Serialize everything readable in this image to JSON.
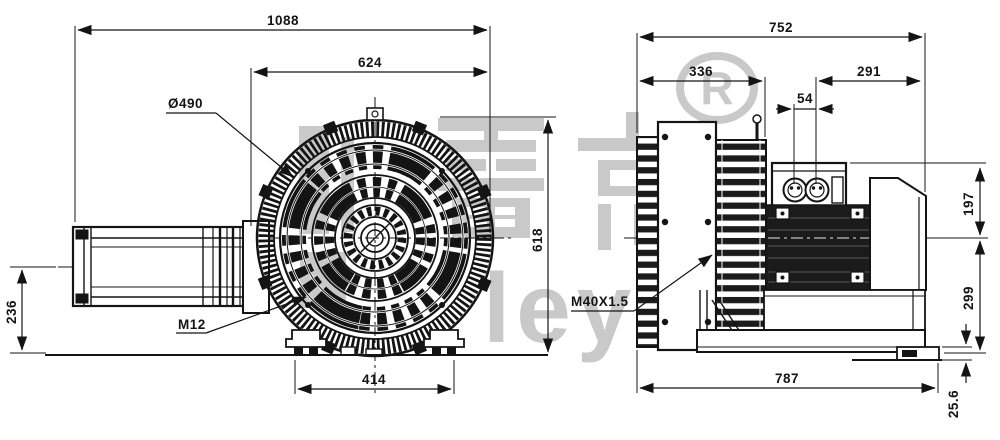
{
  "watermark": {
    "cn": "雷克",
    "latin": "leyk",
    "registered": "R",
    "color": "#c9c9c9"
  },
  "front_view": {
    "dim_overall_width": "1088",
    "dim_housing_width": "624",
    "dim_guard_diameter": "Ø490",
    "dim_total_height": "618",
    "dim_inlet_center_height": "236",
    "dim_foot_spacing": "414",
    "label_foot_thread": "M12"
  },
  "side_view": {
    "dim_overall_depth": "752",
    "dim_housing_depth": "336",
    "dim_motor_length": "291",
    "dim_gland_spacing": "54",
    "dim_height_above_center": "197",
    "dim_height_below_center": "299",
    "dim_base_length": "787",
    "dim_foot_height": "25.6",
    "label_cable_gland": "M40X1.5"
  },
  "ink": "#141414"
}
